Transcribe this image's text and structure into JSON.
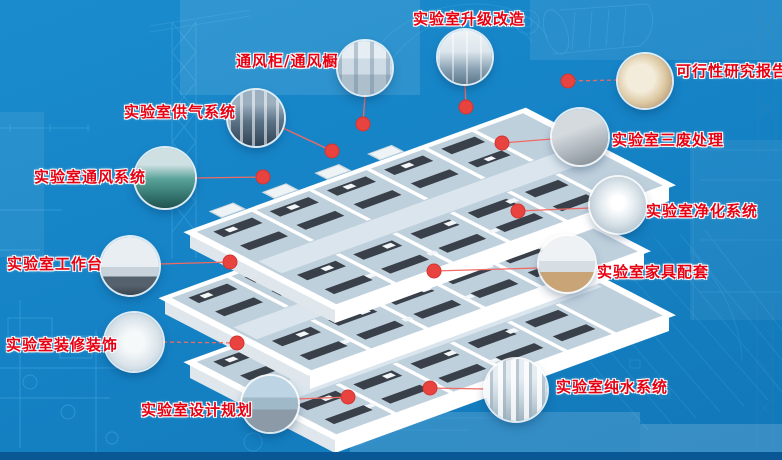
{
  "page": {
    "description": "Laboratory engineering services infographic with 3D lab building model",
    "colors": {
      "background": "#1583c6",
      "blueprint_line": "#45a8e0",
      "label_red": "#e60012",
      "label_outline": "#ffffff",
      "leader_line_red": "#f06a64",
      "dot_red": "#e8433f",
      "bottom_bar_blue": "#0a5795",
      "slab_white": "#ffffff",
      "floor_fill": "#bfd0dd",
      "bench_dark": "#394049"
    }
  },
  "callouts": [
    {
      "id": "upgrade",
      "label": "实验室升级改造"
    },
    {
      "id": "fume-hood",
      "label": "通风柜/通风橱"
    },
    {
      "id": "feasibility",
      "label": "可行性研究报告"
    },
    {
      "id": "gas-supply",
      "label": "实验室供气系统"
    },
    {
      "id": "waste-treatment",
      "label": "实验室三废处理"
    },
    {
      "id": "ventilation",
      "label": "实验室通风系统"
    },
    {
      "id": "purification",
      "label": "实验室净化系统"
    },
    {
      "id": "workbench",
      "label": "实验室工作台"
    },
    {
      "id": "furniture",
      "label": "实验室家具配套"
    },
    {
      "id": "decoration",
      "label": "实验室装修装饰"
    },
    {
      "id": "pure-water",
      "label": "实验室纯水系统"
    },
    {
      "id": "design-planning",
      "label": "实验室设计规划"
    }
  ],
  "model": {
    "floors": 3,
    "marker_count": 12,
    "marker_style": "red-dot"
  }
}
